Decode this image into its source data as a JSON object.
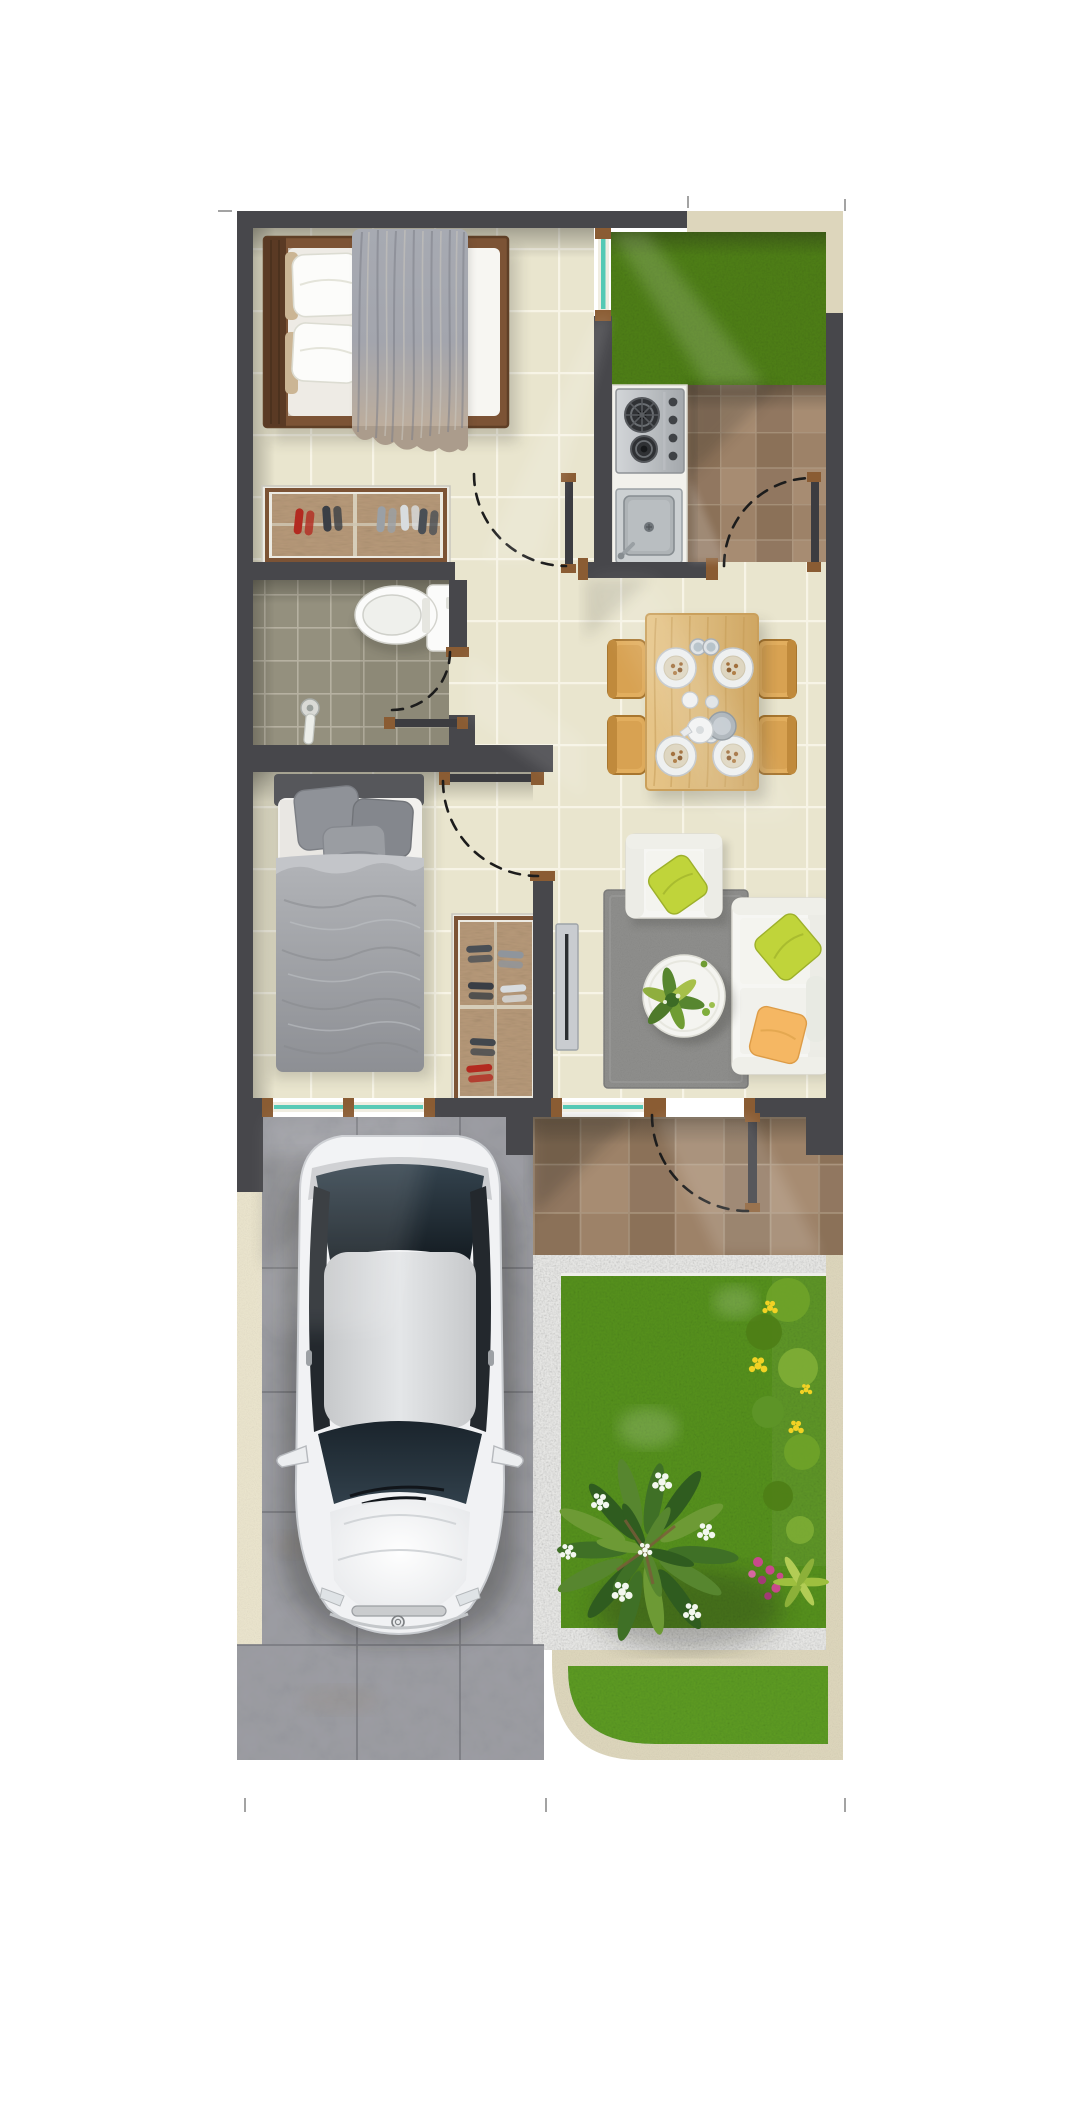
{
  "palette": {
    "bg": "#ffffff",
    "wall": "#47474b",
    "wood": "#8a5c33",
    "glass": "#55c9b5",
    "floorBeige": "#e9e5ce",
    "groutBeige": "#f7f4e7",
    "floorBath": "#94907e",
    "groutBath": "#b9b5a5",
    "tileBrownA": "#9d8268",
    "tileBrownB": "#8b7158",
    "tileBrownC": "#a78c72",
    "tileBrownD": "#917760",
    "groutBrown": "#b09c85",
    "grassYard": "#4e7e16",
    "grassGarden": "#55901c",
    "grassStrip": "#5c9a22",
    "pebble": "#e6e6e4",
    "curb": "#ddd6bc",
    "walkway": "#eae4cd",
    "drive": "#9b9ca2",
    "driveJoint": "#797a80",
    "carBody": "#f1f2f4",
    "carGlass": "#2c3942",
    "carRoof": "#d6d8da",
    "sofaWhite": "#f6f6f3",
    "pillowGreen": "#c0d43a",
    "pillowOrange": "#f5b763",
    "rugGray": "#8e8e8c",
    "tableWood": "#ddbb7e",
    "chairWood": "#e2ae5e",
    "bedFrame": "#7c5335",
    "blanketGray": "#a3a5ad",
    "bed2Gray": "#9b9da1",
    "rackWeave": "#b59878",
    "porcelain": "#fbfbfa",
    "steel": "#c2c5c8",
    "plantDark": "#2f5c1f",
    "plantMid": "#57862f",
    "plantLight": "#8fae3e",
    "flowerYellow": "#f2d224",
    "flowerPink": "#c8498b",
    "flowerWhite": "#f3f7ef",
    "arc": "#1c1c1c",
    "tick": "#8c8c8c"
  },
  "scene": {
    "type": "rendered-floor-plan-top-view",
    "rooms": [
      "bedroom-1",
      "service-yard-grass",
      "kitchen",
      "service-patio",
      "bathroom",
      "hallway",
      "dining-room",
      "bedroom-2",
      "living-room"
    ],
    "outdoor": [
      "front-porch",
      "carport",
      "driveway",
      "side-walkway",
      "pebble-border",
      "garden",
      "street-lawn-strip"
    ],
    "furniture": [
      "double-bed",
      "shoe-rack",
      "toilet",
      "shower-mixer",
      "gas-stove",
      "kitchen-sink",
      "dining-table-with-tableware",
      "dining-chairs",
      "single-bed",
      "shoe-cabinet",
      "wall-tv",
      "armchair",
      "sofa",
      "round-coffee-table",
      "area-rug"
    ],
    "vehicle": "white-sedan-top-view",
    "doors": [
      "service-door-swing",
      "bedroom-1-door-swing",
      "bathroom-door-swing",
      "bedroom-2-door-swing",
      "front-door-swing"
    ],
    "windows": [
      "bedroom-1-side-window",
      "bedroom-2-front-window",
      "living-room-front-window"
    ],
    "plants": [
      "plumeria-shrub-white-flowers",
      "yellow-flower-hedge",
      "pink-flower-cluster",
      "fern"
    ]
  }
}
